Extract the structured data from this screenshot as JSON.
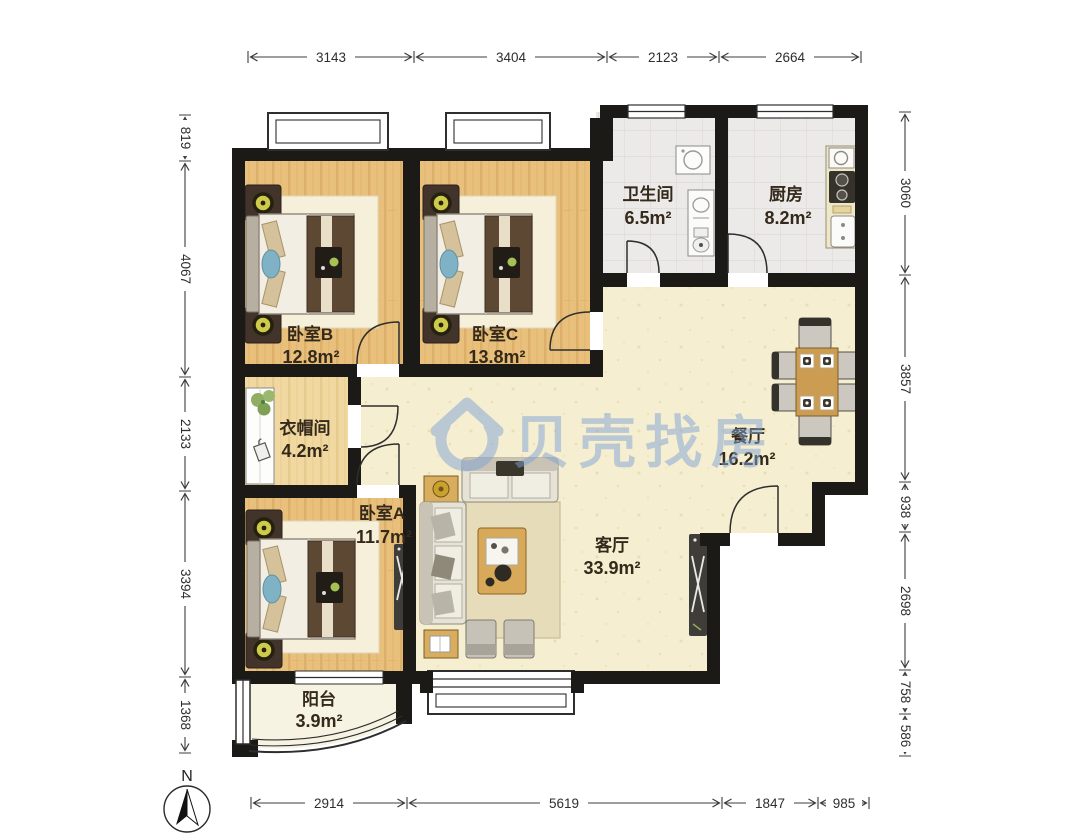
{
  "watermark": {
    "brand": "贝壳找房"
  },
  "compass": {
    "label": "N"
  },
  "rooms": [
    {
      "id": "bedroom-b",
      "name": "卧室B",
      "area": "12.8m²"
    },
    {
      "id": "bedroom-c",
      "name": "卧室C",
      "area": "13.8m²"
    },
    {
      "id": "bathroom",
      "name": "卫生间",
      "area": "6.5m²"
    },
    {
      "id": "kitchen",
      "name": "厨房",
      "area": "8.2m²"
    },
    {
      "id": "cloakroom",
      "name": "衣帽间",
      "area": "4.2m²"
    },
    {
      "id": "dining",
      "name": "餐厅",
      "area": "16.2m²"
    },
    {
      "id": "bedroom-a",
      "name": "卧室A",
      "area": "11.7m²"
    },
    {
      "id": "living",
      "name": "客厅",
      "area": "33.9m²"
    },
    {
      "id": "balcony",
      "name": "阳台",
      "area": "3.9m²"
    }
  ],
  "dimensions": {
    "top": [
      "3143",
      "3404",
      "2123",
      "2664"
    ],
    "left": [
      "819",
      "4067",
      "2133",
      "3394",
      "1368"
    ],
    "right": [
      "3060",
      "3857",
      "938",
      "2698",
      "758",
      "586"
    ],
    "bottom": [
      "2914",
      "5619",
      "1847",
      "985"
    ]
  },
  "colors": {
    "wall": "#1b1a17",
    "wood_floor": "#e9c07b",
    "public_floor": "#f5eed0",
    "tile_floor": "#eceae8",
    "watermark_blue": "#7fa3d4"
  }
}
